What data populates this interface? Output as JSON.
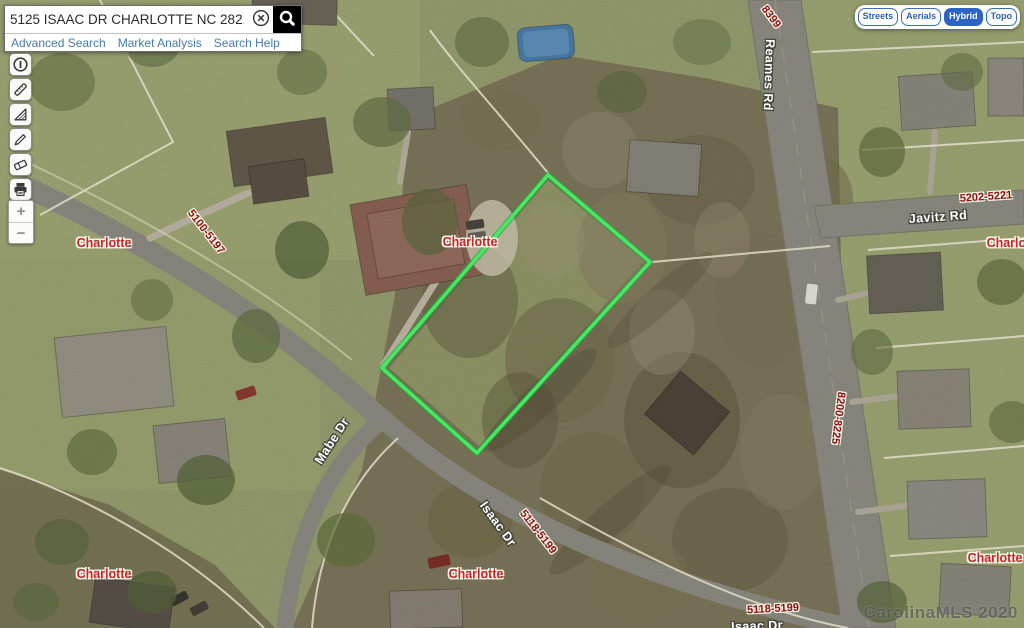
{
  "search": {
    "query": "5125 ISAAC DR CHARLOTTE NC 28216",
    "links": [
      "Advanced Search",
      "Market Analysis",
      "Search Help"
    ]
  },
  "basemap": {
    "buttons": [
      {
        "label": "Streets",
        "active": false
      },
      {
        "label": "Aerials",
        "active": false
      },
      {
        "label": "Hybrid",
        "active": true
      },
      {
        "label": "Topo",
        "active": false
      }
    ],
    "active_color": "#2e63c6",
    "text_color": "#2d62ae"
  },
  "toolbar": {
    "tools": [
      "identify",
      "measure-distance",
      "measure-area",
      "draw",
      "erase",
      "print"
    ]
  },
  "zoom_controls": {
    "zoom_in": "+",
    "zoom_out": "−"
  },
  "parcel_highlight": {
    "points": "548,175 650,262 477,453 382,368",
    "color": "#3fe35d"
  },
  "map_labels": [
    {
      "text": "8399",
      "type": "parcel",
      "x": 771,
      "y": 17,
      "rot": 53,
      "name": "parcel-label-8399"
    },
    {
      "text": "Reames Rd",
      "type": "road",
      "x": 769,
      "y": 75,
      "rot": 92,
      "name": "road-label-reames-rd"
    },
    {
      "text": "5202-5221",
      "type": "parcel",
      "x": 986,
      "y": 197,
      "rot": -4,
      "name": "parcel-label-5202-5221"
    },
    {
      "text": "Javitz Rd",
      "type": "road",
      "x": 938,
      "y": 217,
      "rot": -4,
      "name": "road-label-javitz-rd"
    },
    {
      "text": "5100-5197",
      "type": "parcel",
      "x": 206,
      "y": 232,
      "rot": 52,
      "name": "parcel-label-5100-5197"
    },
    {
      "text": "Charlotte",
      "type": "city",
      "x": 104,
      "y": 243,
      "rot": 0,
      "name": "city-label-charlotte-1"
    },
    {
      "text": "Charlotte",
      "type": "city",
      "x": 470,
      "y": 242,
      "rot": 0,
      "name": "city-label-charlotte-2"
    },
    {
      "text": "Charlotte",
      "type": "city",
      "x": 1014,
      "y": 243,
      "rot": 0,
      "name": "city-label-charlotte-3"
    },
    {
      "text": "Mabe Dr",
      "type": "road",
      "x": 332,
      "y": 441,
      "rot": -57,
      "name": "road-label-mabe-dr"
    },
    {
      "text": "Isaac Dr",
      "type": "road",
      "x": 498,
      "y": 524,
      "rot": 54,
      "name": "road-label-isaac-dr-1"
    },
    {
      "text": "5118-5199",
      "type": "parcel",
      "x": 538,
      "y": 532,
      "rot": 52,
      "name": "parcel-label-5118-5199-a"
    },
    {
      "text": "8200-8225",
      "type": "parcel",
      "x": 838,
      "y": 418,
      "rot": 97,
      "name": "parcel-label-8200-8225"
    },
    {
      "text": "5118-5199",
      "type": "parcel",
      "x": 773,
      "y": 609,
      "rot": -3,
      "name": "parcel-label-5118-5199-b"
    },
    {
      "text": "Isaac Dr",
      "type": "road",
      "x": 757,
      "y": 626,
      "rot": -2,
      "name": "road-label-isaac-dr-2"
    },
    {
      "text": "Charlotte",
      "type": "city",
      "x": 104,
      "y": 574,
      "rot": 0,
      "name": "city-label-charlotte-4"
    },
    {
      "text": "Charlotte",
      "type": "city",
      "x": 476,
      "y": 574,
      "rot": 0,
      "name": "city-label-charlotte-5"
    },
    {
      "text": "Charlotte",
      "type": "city",
      "x": 995,
      "y": 558,
      "rot": 0,
      "name": "city-label-charlotte-6"
    }
  ],
  "watermark": "CarolinaMLS 2020",
  "colors": {
    "road_label": "#ffffff",
    "parcel_label": "#8a1216",
    "city_label": "#c3272b",
    "link_blue": "#4a79a8",
    "highlight_green": "#3fe35d"
  }
}
